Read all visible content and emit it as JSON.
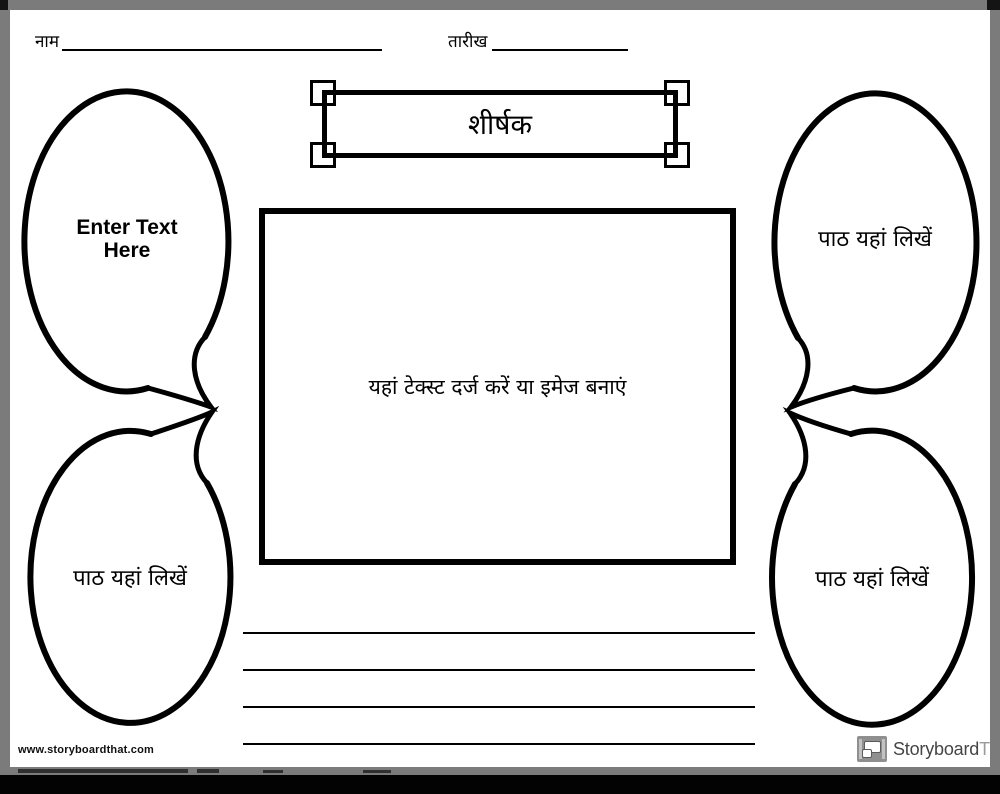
{
  "header": {
    "name_label": "नाम",
    "date_label": "तारीख"
  },
  "title_box": {
    "title": "शीर्षक"
  },
  "bubbles": {
    "top_left": "Enter Text Here",
    "top_right": "पाठ यहां लिखें",
    "bottom_left": "पाठ यहां लिखें",
    "bottom_right": "पाठ यहां लिखें"
  },
  "image_box": {
    "placeholder": "यहां टेक्स्ट दर्ज करें या इमेज बनाएं"
  },
  "writing_lines": {
    "count": 4
  },
  "footer": {
    "website": "www.storyboardthat.com",
    "brand_primary": "Storyboard",
    "brand_secondary": "That"
  },
  "colors": {
    "ink": "#000000",
    "frame_gray": "#7b7b7b",
    "logo_gray": "#8f8f8f",
    "brand_dark": "#454545",
    "brand_light": "#9b9b9b"
  }
}
